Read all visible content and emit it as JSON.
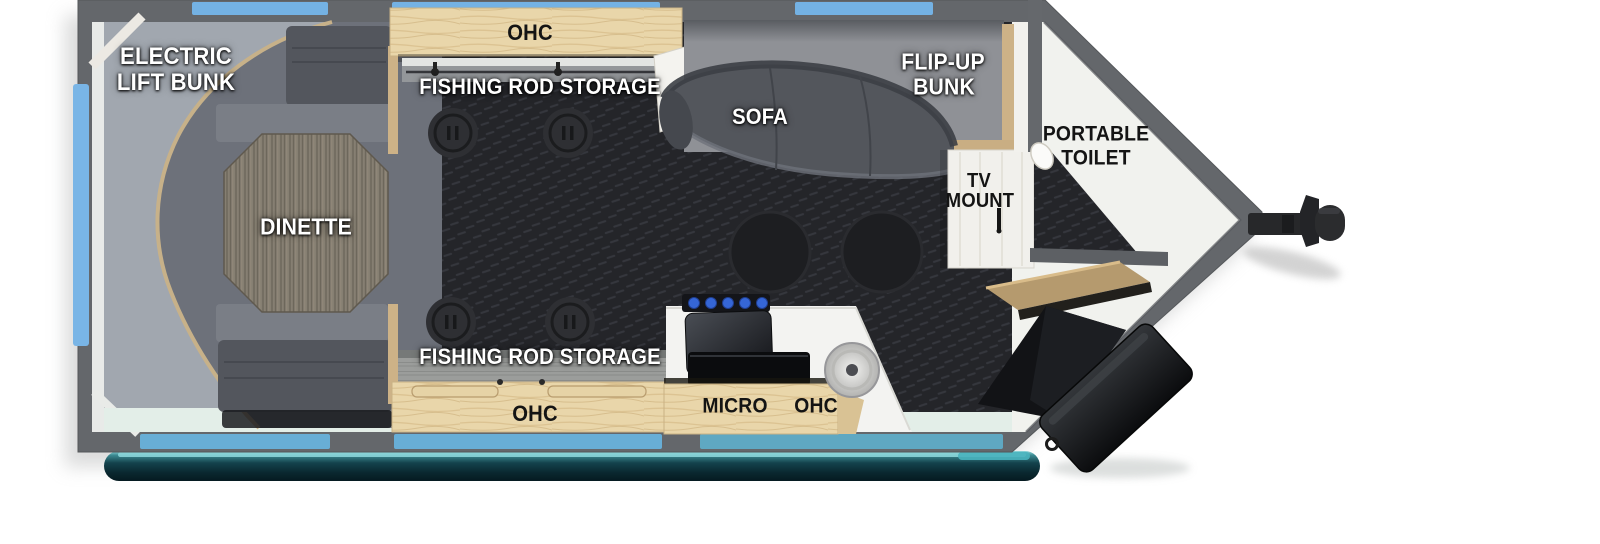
{
  "floorplan": {
    "areas": {
      "electric_lift_bunk": {
        "line1": "ELECTRIC",
        "line2": "LIFT BUNK"
      },
      "overhead_cabinet_top": {
        "label": "OHC"
      },
      "fishing_rod_storage_top": {
        "label": "FISHING ROD STORAGE"
      },
      "sofa": {
        "label": "SOFA"
      },
      "flip_up_bunk": {
        "line1": "FLIP-UP",
        "line2": "BUNK"
      },
      "portable_toilet": {
        "line1": "PORTABLE",
        "line2": "TOILET"
      },
      "tv_mount": {
        "line1": "TV",
        "line2": "MOUNT"
      },
      "dinette": {
        "label": "DINETTE"
      },
      "fishing_rod_storage_bottom": {
        "label": "FISHING ROD STORAGE"
      },
      "overhead_cabinet_bottom": {
        "label": "OHC"
      },
      "kitchen": {
        "micro_label": "MICRO",
        "ohc_label": "OHC"
      }
    },
    "colors": {
      "wall_gray": "#64676b",
      "window_blue": "#74b2e4",
      "floor_charcoal": "#242529",
      "carpet_gray": "#a1a7af",
      "cabinet_wood_light": "#e9d6aa",
      "table_wood_gray": "#867f72",
      "awning_teal_dark": "#14424c",
      "furniture_gray": "#53565c",
      "burner_knob_blue": "#3566d6"
    }
  }
}
